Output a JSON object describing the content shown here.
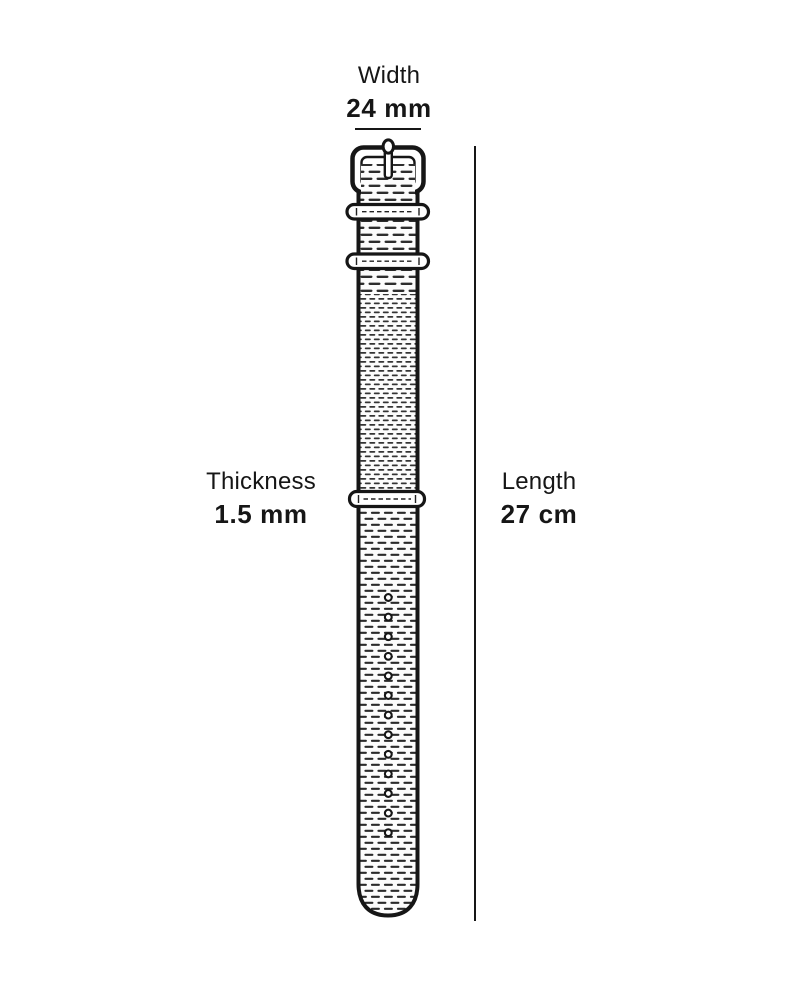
{
  "page": {
    "background": "#ffffff",
    "ink": "#161616"
  },
  "diagram": {
    "name": "watch-strap-dimension-diagram",
    "strap_type": "nato-strap",
    "width": {
      "label": "Width",
      "value": "24 mm"
    },
    "thickness": {
      "label": "Thickness",
      "value": "1.5 mm"
    },
    "length": {
      "label": "Length",
      "value": "27 cm"
    },
    "strap": {
      "hole_count": 13,
      "keeper_count": 3
    }
  }
}
